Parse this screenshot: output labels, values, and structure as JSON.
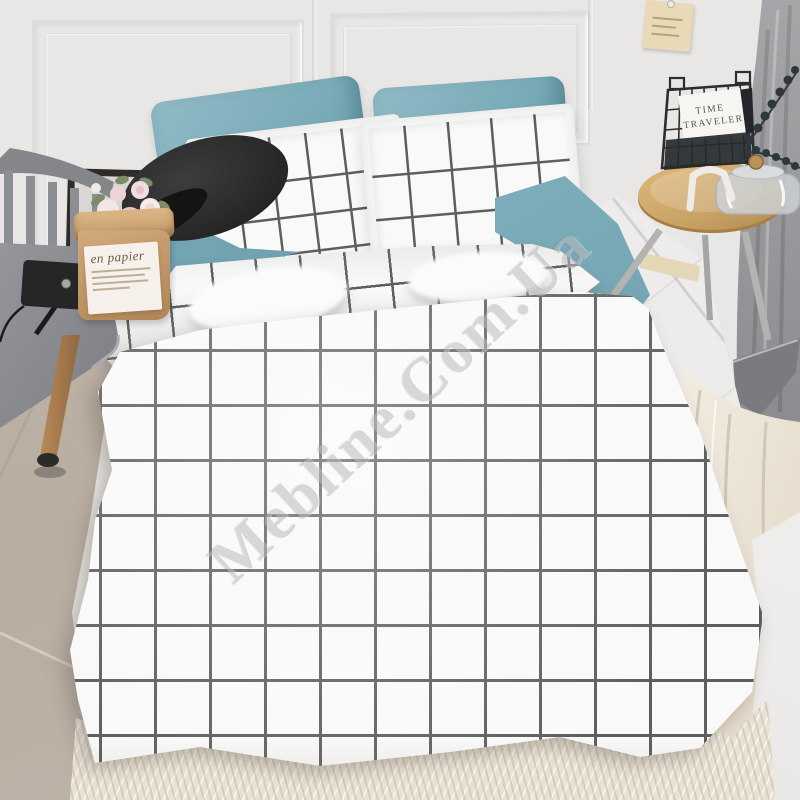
{
  "watermark": {
    "text": "Mebline.Com.Ua"
  },
  "paper_bag": {
    "label_title": "en papier"
  },
  "basket_card": {
    "line1": "TIME",
    "line2": "TRAVELER"
  },
  "colors": {
    "wall": "#e9e7e5",
    "blue": "#79aab7",
    "blue-dark": "#5f93a3",
    "blue-light": "#90bbc6",
    "gridline": "#5e5e5e",
    "fabric": "#f9f9f9",
    "chair": "#8b8e92",
    "wood": "#a87c50",
    "lamp": "#262626",
    "kraft": "#c49b6c",
    "frame": "#2e2b28",
    "stool-wood": "#c9a266",
    "metal": "#b5b3b1",
    "basket": "#2d2d2d",
    "plant": "#2e363e",
    "curtain": "#98979b",
    "drape": "#eee7d9",
    "floor-left": "#b9ada1",
    "tile": "#edecea",
    "rug": "#e9e2d4",
    "tag": "#ead9b6",
    "watermark": "#bcbbbb"
  }
}
